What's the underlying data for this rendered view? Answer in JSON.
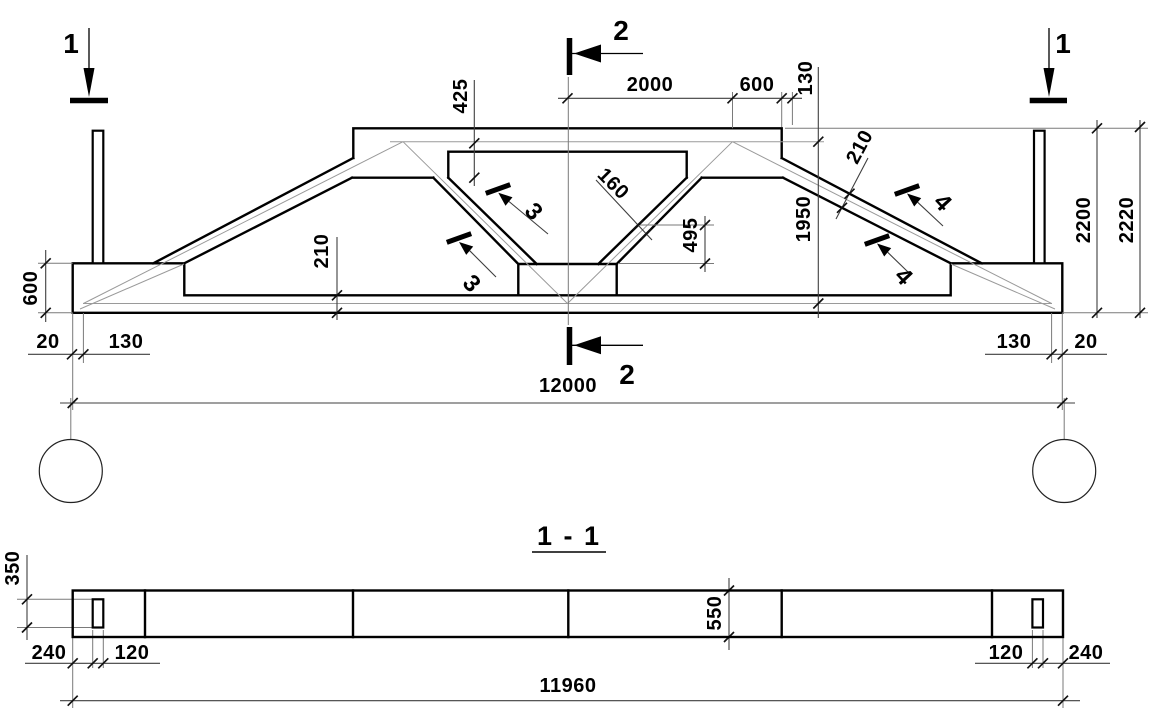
{
  "drawing_type": "truss girder working drawing",
  "elevation": {
    "section_marker_1": "1",
    "section_marker_2": "2",
    "cut_mark_3": "3",
    "cut_mark_4": "4",
    "dims": {
      "top_half_span": "2000",
      "top_slope_seg": "600",
      "top_edge_seg": "130",
      "slab_depth": "425",
      "web_thickness": "160",
      "web_drop": "495",
      "chord_thickness_right": "210",
      "bottom_chord_thickness": "210",
      "axis_height": "1950",
      "overall_height": "2200",
      "total_height": "2220",
      "support_height": "600",
      "span": "12000",
      "left_gap": "20",
      "left_bearing": "130",
      "right_bearing": "130",
      "right_gap": "20"
    }
  },
  "section": {
    "title": "1 - 1",
    "dims": {
      "loop_height": "350",
      "strip_width": "550",
      "left_edge": "240",
      "left_loop": "120",
      "right_loop": "120",
      "right_edge": "240",
      "length": "11960"
    }
  }
}
